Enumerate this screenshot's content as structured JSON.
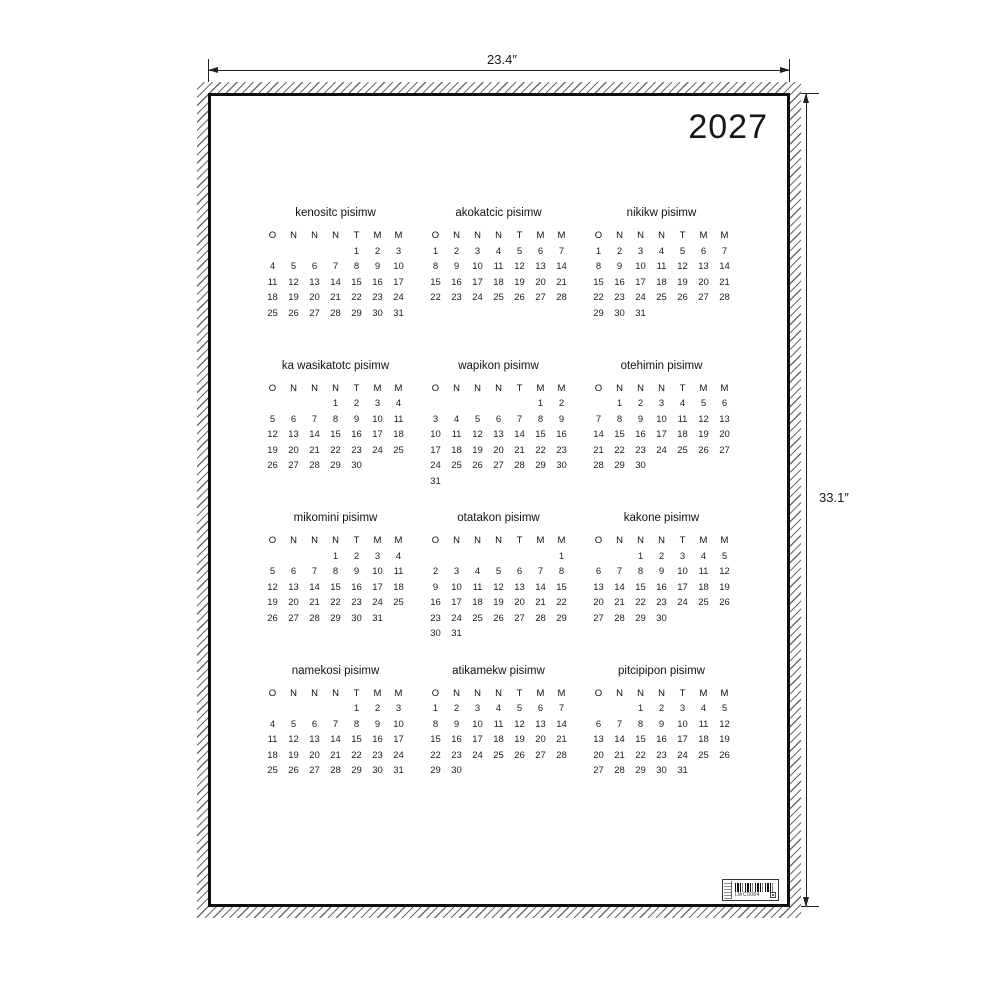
{
  "page": {
    "year": "2027"
  },
  "dimensions": {
    "width_label": "23.4″",
    "height_label": "33.1″"
  },
  "calendar": {
    "weekday_headers": [
      "O",
      "N",
      "N",
      "N",
      "T",
      "M",
      "M"
    ],
    "months": [
      {
        "name": "kenositc pisimw",
        "weeks": [
          [
            "",
            "",
            "",
            "",
            "1",
            "2",
            "3"
          ],
          [
            "4",
            "5",
            "6",
            "7",
            "8",
            "9",
            "10"
          ],
          [
            "11",
            "12",
            "13",
            "14",
            "15",
            "16",
            "17"
          ],
          [
            "18",
            "19",
            "20",
            "21",
            "22",
            "23",
            "24"
          ],
          [
            "25",
            "26",
            "27",
            "28",
            "29",
            "30",
            "31"
          ]
        ]
      },
      {
        "name": "akokatcic pisimw",
        "weeks": [
          [
            "1",
            "2",
            "3",
            "4",
            "5",
            "6",
            "7"
          ],
          [
            "8",
            "9",
            "10",
            "11",
            "12",
            "13",
            "14"
          ],
          [
            "15",
            "16",
            "17",
            "18",
            "19",
            "20",
            "21"
          ],
          [
            "22",
            "23",
            "24",
            "25",
            "26",
            "27",
            "28"
          ]
        ]
      },
      {
        "name": "nikikw pisimw",
        "weeks": [
          [
            "1",
            "2",
            "3",
            "4",
            "5",
            "6",
            "7"
          ],
          [
            "8",
            "9",
            "10",
            "11",
            "12",
            "13",
            "14"
          ],
          [
            "15",
            "16",
            "17",
            "18",
            "19",
            "20",
            "21"
          ],
          [
            "22",
            "23",
            "24",
            "25",
            "26",
            "27",
            "28"
          ],
          [
            "29",
            "30",
            "31",
            "",
            "",
            "",
            ""
          ]
        ]
      },
      {
        "name": "ka wasikatotc pisimw",
        "weeks": [
          [
            "",
            "",
            "",
            "1",
            "2",
            "3",
            "4"
          ],
          [
            "5",
            "6",
            "7",
            "8",
            "9",
            "10",
            "11"
          ],
          [
            "12",
            "13",
            "14",
            "15",
            "16",
            "17",
            "18"
          ],
          [
            "19",
            "20",
            "21",
            "22",
            "23",
            "24",
            "25"
          ],
          [
            "26",
            "27",
            "28",
            "29",
            "30",
            "",
            ""
          ]
        ]
      },
      {
        "name": "wapikon pisimw",
        "weeks": [
          [
            "",
            "",
            "",
            "",
            "",
            "1",
            "2"
          ],
          [
            "3",
            "4",
            "5",
            "6",
            "7",
            "8",
            "9"
          ],
          [
            "10",
            "11",
            "12",
            "13",
            "14",
            "15",
            "16"
          ],
          [
            "17",
            "18",
            "19",
            "20",
            "21",
            "22",
            "23"
          ],
          [
            "24",
            "25",
            "26",
            "27",
            "28",
            "29",
            "30"
          ],
          [
            "31",
            "",
            "",
            "",
            "",
            "",
            ""
          ]
        ]
      },
      {
        "name": "otehimin pisimw",
        "weeks": [
          [
            "",
            "1",
            "2",
            "3",
            "4",
            "5",
            "6"
          ],
          [
            "7",
            "8",
            "9",
            "10",
            "11",
            "12",
            "13"
          ],
          [
            "14",
            "15",
            "16",
            "17",
            "18",
            "19",
            "20"
          ],
          [
            "21",
            "22",
            "23",
            "24",
            "25",
            "26",
            "27"
          ],
          [
            "28",
            "29",
            "30",
            "",
            "",
            "",
            ""
          ]
        ]
      },
      {
        "name": "mikomini pisimw",
        "weeks": [
          [
            "",
            "",
            "",
            "1",
            "2",
            "3",
            "4"
          ],
          [
            "5",
            "6",
            "7",
            "8",
            "9",
            "10",
            "11"
          ],
          [
            "12",
            "13",
            "14",
            "15",
            "16",
            "17",
            "18"
          ],
          [
            "19",
            "20",
            "21",
            "22",
            "23",
            "24",
            "25"
          ],
          [
            "26",
            "27",
            "28",
            "29",
            "30",
            "31",
            ""
          ]
        ]
      },
      {
        "name": "otatakon pisimw",
        "weeks": [
          [
            "",
            "",
            "",
            "",
            "",
            "",
            "1"
          ],
          [
            "2",
            "3",
            "4",
            "5",
            "6",
            "7",
            "8"
          ],
          [
            "9",
            "10",
            "11",
            "12",
            "13",
            "14",
            "15"
          ],
          [
            "16",
            "17",
            "18",
            "19",
            "20",
            "21",
            "22"
          ],
          [
            "23",
            "24",
            "25",
            "26",
            "27",
            "28",
            "29"
          ],
          [
            "30",
            "31",
            "",
            "",
            "",
            "",
            ""
          ]
        ]
      },
      {
        "name": "kakone pisimw",
        "weeks": [
          [
            "",
            "",
            "1",
            "2",
            "3",
            "4",
            "5"
          ],
          [
            "6",
            "7",
            "8",
            "9",
            "10",
            "11",
            "12"
          ],
          [
            "13",
            "14",
            "15",
            "16",
            "17",
            "18",
            "19"
          ],
          [
            "20",
            "21",
            "22",
            "23",
            "24",
            "25",
            "26"
          ],
          [
            "27",
            "28",
            "29",
            "30",
            "",
            "",
            ""
          ]
        ]
      },
      {
        "name": "namekosi pisimw",
        "weeks": [
          [
            "",
            "",
            "",
            "",
            "1",
            "2",
            "3"
          ],
          [
            "4",
            "5",
            "6",
            "7",
            "8",
            "9",
            "10"
          ],
          [
            "11",
            "12",
            "13",
            "14",
            "15",
            "16",
            "17"
          ],
          [
            "18",
            "19",
            "20",
            "21",
            "22",
            "23",
            "24"
          ],
          [
            "25",
            "26",
            "27",
            "28",
            "29",
            "30",
            "31"
          ]
        ]
      },
      {
        "name": "atikamekw pisimw",
        "weeks": [
          [
            "1",
            "2",
            "3",
            "4",
            "5",
            "6",
            "7"
          ],
          [
            "8",
            "9",
            "10",
            "11",
            "12",
            "13",
            "14"
          ],
          [
            "15",
            "16",
            "17",
            "18",
            "19",
            "20",
            "21"
          ],
          [
            "22",
            "23",
            "24",
            "25",
            "26",
            "27",
            "28"
          ],
          [
            "29",
            "30",
            "",
            "",
            "",
            "",
            ""
          ]
        ]
      },
      {
        "name": "pitcipipon pisimw",
        "weeks": [
          [
            "",
            "",
            "1",
            "2",
            "3",
            "4",
            "5"
          ],
          [
            "6",
            "7",
            "8",
            "9",
            "10",
            "11",
            "12"
          ],
          [
            "13",
            "14",
            "15",
            "16",
            "17",
            "18",
            "19"
          ],
          [
            "20",
            "21",
            "22",
            "23",
            "24",
            "25",
            "26"
          ],
          [
            "27",
            "28",
            "29",
            "30",
            "31",
            "",
            ""
          ]
        ]
      }
    ]
  },
  "label": {
    "barcode_text": "LWC0084"
  }
}
